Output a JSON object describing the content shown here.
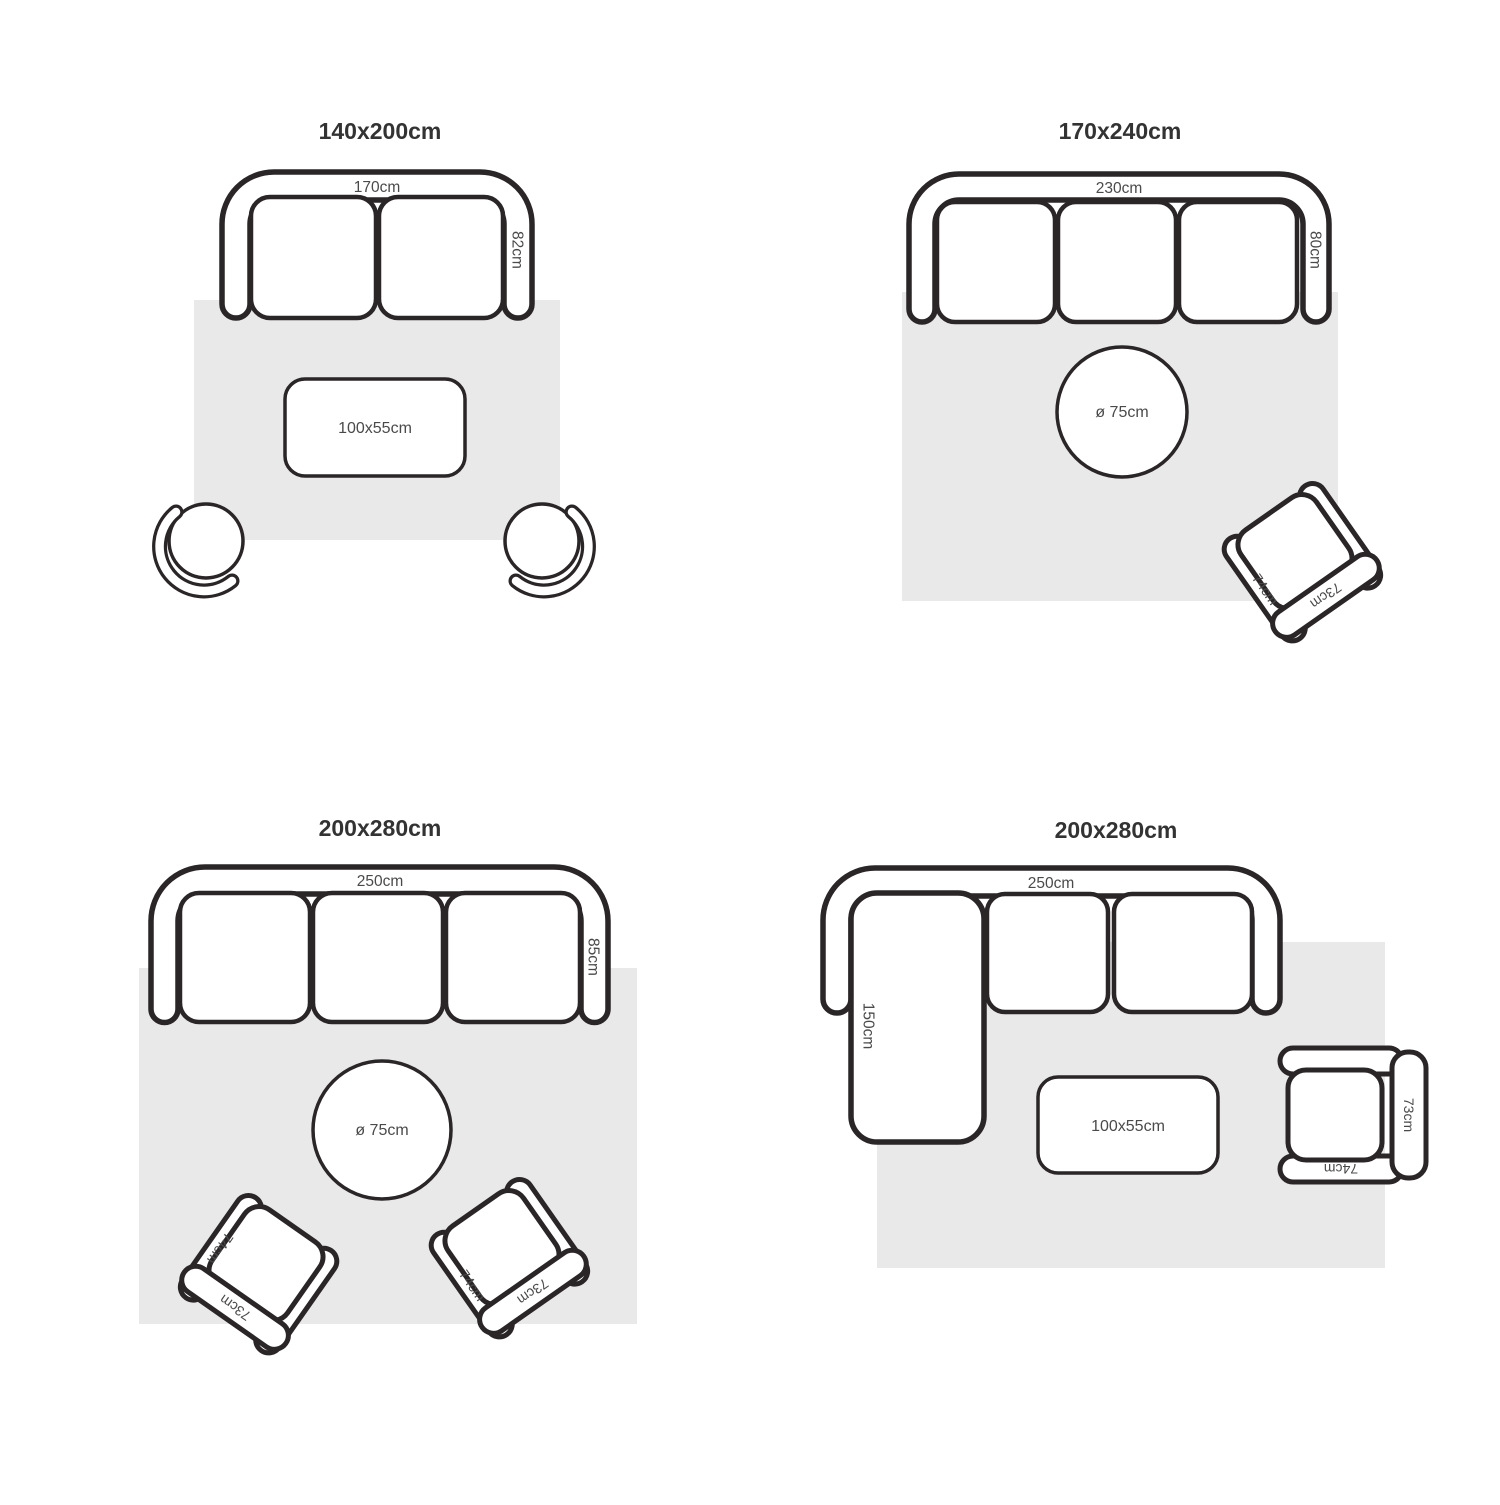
{
  "colors": {
    "outline": "#2a2627",
    "rug": "#e9e9e9",
    "label": "#4a4a4a",
    "title": "#333333",
    "background": "#ffffff"
  },
  "quadrants": [
    {
      "title": "140x200cm",
      "sofa": {
        "type": "2-seat",
        "width_label": "170cm",
        "depth_label": "82cm"
      },
      "table": {
        "shape": "rectangle",
        "label": "100x55cm"
      },
      "poufs": {
        "count": 2
      }
    },
    {
      "title": "170x240cm",
      "sofa": {
        "type": "3-seat",
        "width_label": "230cm",
        "depth_label": "80cm"
      },
      "table": {
        "shape": "round",
        "label": "ø 75cm"
      },
      "chair": {
        "arm_label": "74cm",
        "back_label": "73cm"
      }
    },
    {
      "title": "200x280cm",
      "sofa": {
        "type": "3-seat",
        "width_label": "250cm",
        "depth_label": "85cm"
      },
      "table": {
        "shape": "round",
        "label": "ø 75cm"
      },
      "chairs": [
        {
          "arm_label": "74cm",
          "back_label": "73cm"
        },
        {
          "arm_label": "74cm",
          "back_label": "73cm"
        }
      ]
    },
    {
      "title": "200x280cm",
      "sofa": {
        "type": "corner-sectional",
        "width_label": "250cm",
        "chaise_label": "150cm"
      },
      "table": {
        "shape": "rectangle",
        "label": "100x55cm"
      },
      "chair": {
        "side_label": "73cm",
        "front_label": "74cm"
      }
    }
  ]
}
